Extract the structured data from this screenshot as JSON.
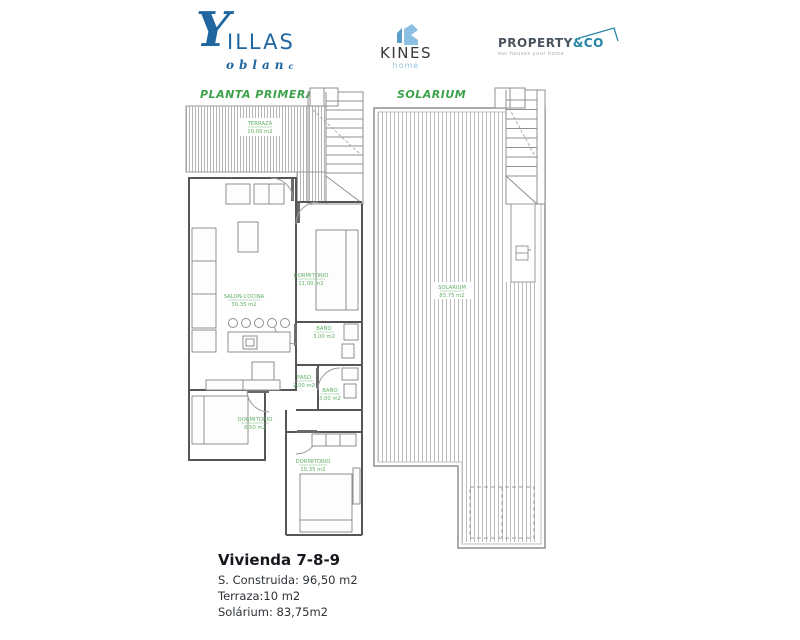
{
  "header": {
    "villas_logo": {
      "glyph": "Y",
      "name_top": "ILLAS",
      "name_bottom": "oblan",
      "name_bottom_small": "c",
      "color": "#2066a0"
    },
    "kines_logo": {
      "name": "KINES",
      "sub": "home",
      "icon_color_light": "#8cc0e2",
      "icon_color_dark": "#5b9ec9",
      "text_color": "#383838"
    },
    "property_logo": {
      "name": "PROPERTY",
      "suffix": "&CO",
      "tagline": "our houses your home",
      "name_color": "#4a545e",
      "suffix_color": "#2383a5"
    }
  },
  "plans": {
    "left": {
      "title": "PLANTA PRIMERA",
      "rooms": [
        {
          "name": "TERRAZA",
          "area": "10,00 m2"
        },
        {
          "name": "SALON-COCINA",
          "area": "30,35 m2"
        },
        {
          "name": "DORMITORIO",
          "area": "11,00 m2"
        },
        {
          "name": "BAÑO",
          "area": "3,00 m2"
        },
        {
          "name": "PASO",
          "area": "2,00 m2"
        },
        {
          "name": "BAÑO",
          "area": "3,00 m2"
        },
        {
          "name": "DORMITORIO",
          "area": "8,50 m2"
        },
        {
          "name": "DORMITORIO",
          "area": "10,35 m2"
        }
      ]
    },
    "right": {
      "title": "SOLARIUM",
      "rooms": [
        {
          "name": "SOLARIUM",
          "area": "83,75 m2"
        }
      ]
    }
  },
  "summary": {
    "title": "Vivienda 7-8-9",
    "lines": [
      "S. Construida: 96,50 m2",
      "Terraza:10 m2",
      "Solárium: 83,75m2"
    ]
  },
  "colors": {
    "accent_green": "#3da24b",
    "room_label_green": "#5fae63",
    "logo_blue": "#2066a0",
    "kines_blue": "#8cc0e2",
    "property_teal": "#2383a5",
    "wall_gray": "#565656",
    "line_gray": "#9b9b9b"
  }
}
